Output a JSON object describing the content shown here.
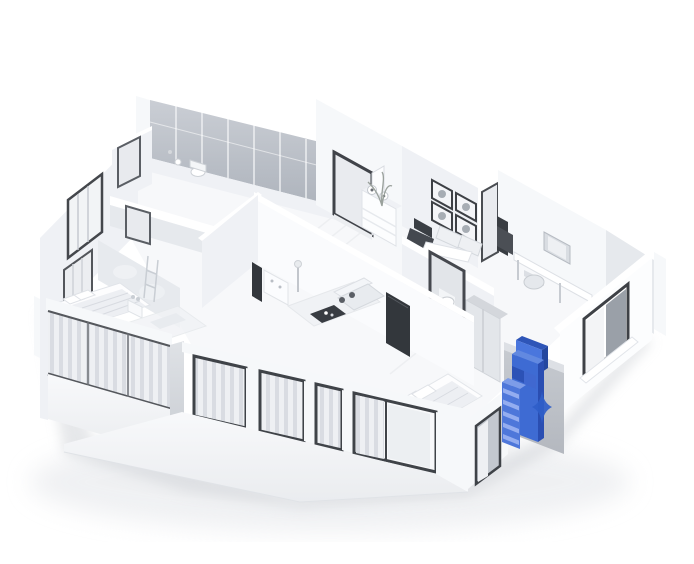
{
  "scene": {
    "type": "3d-isometric-floorplan-render",
    "description": "White 3D cutaway floor plan of an apartment seen from above; all walls and furniture are white or light gray, with a single tall drawer cabinet on the right exterior wall highlighted in blue next to a small blue sparkle marker",
    "background": "#ffffff"
  },
  "colors": {
    "background": "#ffffff",
    "wall_bright": "#f6f8fa",
    "wall_light": "#eff1f5",
    "wall_shade": "#e6e9ed",
    "wall_dark": "#d9dce1",
    "glass_top": "#c8ccd3",
    "glass_bottom": "#aab0b9",
    "alcove_top": "#c6cad0",
    "alcove_bottom": "#b4b8bf",
    "frame_dark": "#3f4247",
    "floor": "#f7f8fa",
    "curtain_light": "#eef0f3",
    "curtain_dark": "#d9dce2",
    "shadow": "#cdd0d5",
    "highlight_front": "#3e6bd3",
    "highlight_top": "#2e55b8",
    "highlight_light": "#6289e0",
    "highlight_side": "#2a4eb2",
    "highlight_upper": "#4a76dd",
    "highlight_mid_dark": "#2c52b6",
    "highlight_mid": "#4068d0",
    "highlight_drawer": "#94adf0",
    "highlight_base": "#4e77da",
    "highlight_base_top": "#7d9ce8",
    "sparkle": "#2f5ec9"
  },
  "rooms": [
    {
      "name": "balcony-glass-wall"
    },
    {
      "name": "entry-hall"
    },
    {
      "name": "kitchen-bath-block"
    },
    {
      "name": "dining-area"
    },
    {
      "name": "living-room"
    },
    {
      "name": "study"
    },
    {
      "name": "master-bedroom"
    },
    {
      "name": "front-bedroom"
    },
    {
      "name": "bathroom"
    }
  ],
  "highlight": {
    "element": "blue-drawer-cabinet",
    "location": "right-facade-alcove",
    "marker": "sparkle-icon"
  }
}
